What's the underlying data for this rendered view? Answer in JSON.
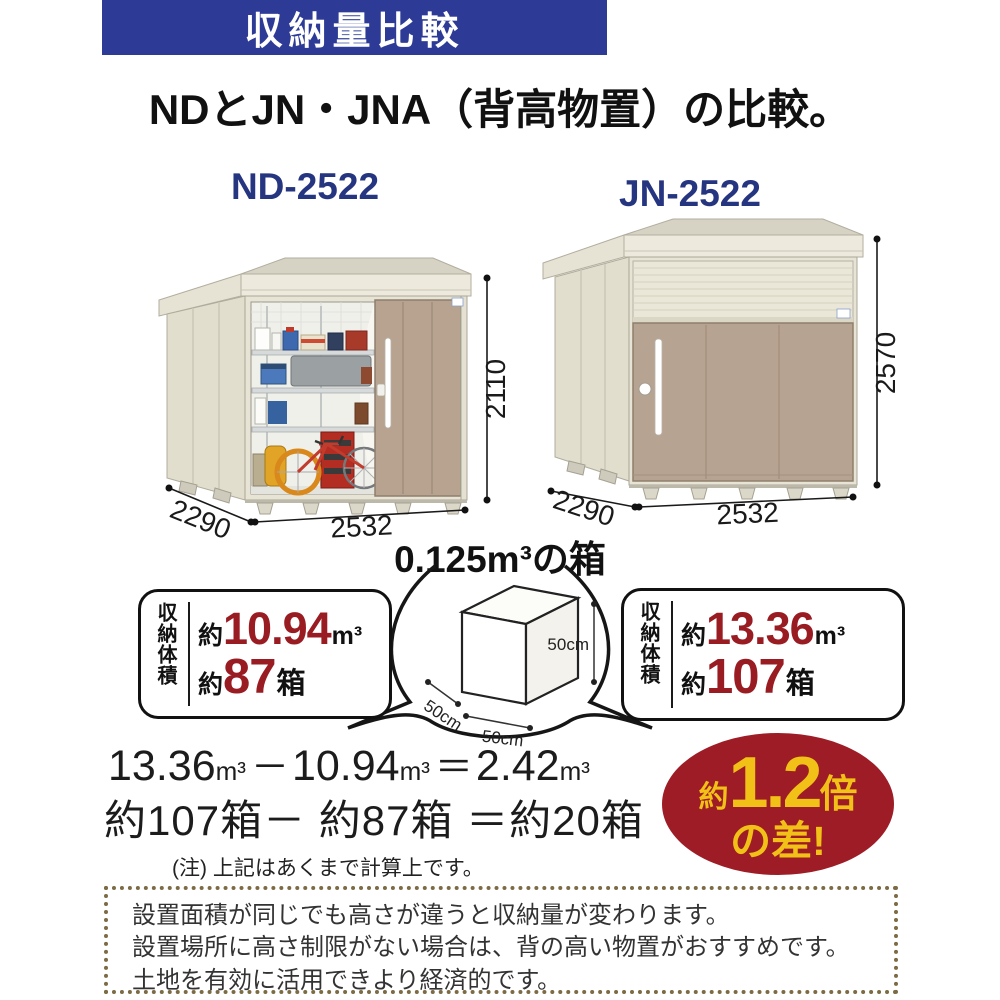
{
  "banner": {
    "label": "収納量比較",
    "bg": "#2d3b96",
    "text_color": "#ffffff"
  },
  "title": "NDとJN・JNA（背高物置）の比較。",
  "sheds": {
    "left": {
      "model": "ND-2522",
      "width": "2532",
      "depth": "2290",
      "height": "2110"
    },
    "right": {
      "model": "JN-2522",
      "width": "2532",
      "depth": "2290",
      "height": "2570"
    }
  },
  "box_demo": {
    "title": "0.125m³の箱",
    "height_label": "50cm",
    "width_label": "50cm",
    "depth_label": "50cm"
  },
  "stats": {
    "left": {
      "label": "収納体積",
      "about": "約",
      "volume": "10.94",
      "volume_unit": "m³",
      "boxes": "87",
      "boxes_unit": "箱"
    },
    "right": {
      "label": "収納体積",
      "about": "約",
      "volume": "13.36",
      "volume_unit": "m³",
      "boxes": "107",
      "boxes_unit": "箱"
    }
  },
  "calc": {
    "v1": "13.36",
    "u1": "m³",
    "minus": "－",
    "v2": "10.94",
    "u2": "m³",
    "equals": "＝",
    "v3": "2.42",
    "u3": "m³",
    "boxes_line": "約107箱－ 約87箱 ＝約20箱",
    "note": "(注) 上記はあくまで計算上です。"
  },
  "badge": {
    "about": "約",
    "value": "1.2",
    "times": "倍",
    "line2": "の差!",
    "bg": "#9d1c26",
    "text_color": "#f2c117"
  },
  "footer": {
    "lines": [
      "設置面積が同じでも高さが違うと収納量が変わります。",
      "設置場所に高さ制限がない場合は、背の高い物置がおすすめです。",
      "土地を有効に活用できより経済的です。"
    ],
    "border_color": "#7c6b45"
  },
  "colors": {
    "accent_red": "#9a1c23",
    "model_label_blue": "#26357f",
    "shed_body": "#e8e4d5",
    "shed_door": "#b7a391"
  }
}
